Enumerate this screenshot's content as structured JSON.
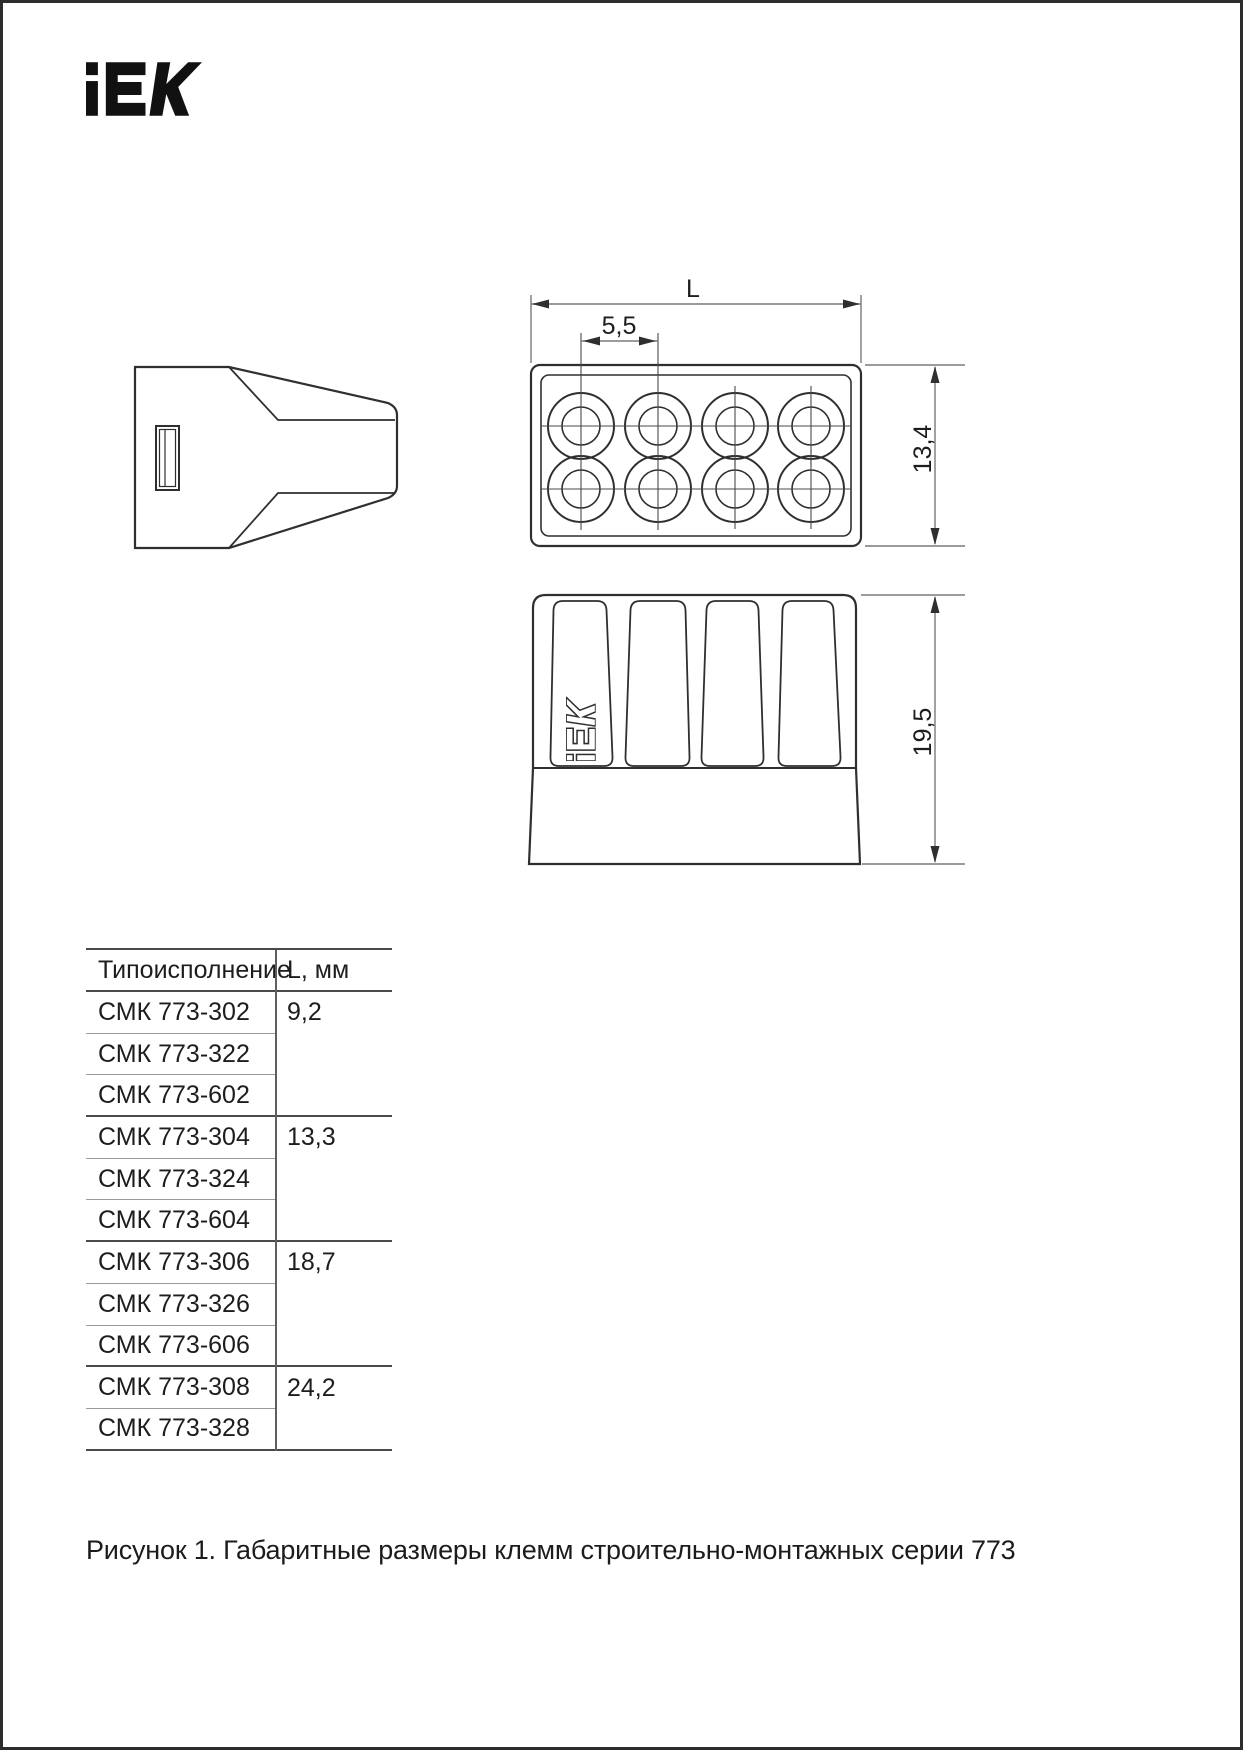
{
  "page": {
    "logo": {
      "name": "iek-logo",
      "text": "IEK"
    },
    "caption": "Рисунок 1. Габаритные размеры клемм строительно-монтажных серии 773"
  },
  "drawing": {
    "labels": {
      "length": "L",
      "pitch": "5,5",
      "body_height": "13,4",
      "total_height": "19,5"
    },
    "embossed_logo": {
      "name": "iek-logo-embossed",
      "text": "IEK"
    },
    "views": [
      "side-view",
      "top-view",
      "front-view"
    ]
  },
  "table": {
    "col_headers": [
      "Типоисполнение",
      "L, мм"
    ],
    "rows": [
      {
        "model": "СМК 773-302",
        "value": "9,2"
      },
      {
        "model": "СМК 773-322",
        "value": ""
      },
      {
        "model": "СМК 773-602",
        "value": ""
      },
      {
        "model": "СМК 773-304",
        "value": "13,3"
      },
      {
        "model": "СМК 773-324",
        "value": ""
      },
      {
        "model": "СМК 773-604",
        "value": ""
      },
      {
        "model": "СМК 773-306",
        "value": "18,7"
      },
      {
        "model": "СМК 773-326",
        "value": ""
      },
      {
        "model": "СМК 773-606",
        "value": ""
      },
      {
        "model": "СМК 773-308",
        "value": "24,2"
      },
      {
        "model": "СМК 773-328",
        "value": ""
      }
    ]
  },
  "colors": {
    "ink": "#1d1d1d",
    "outline": "#2f2f2f",
    "dim_line": "#7a7a7a",
    "table_rule_strong": "#4a4a4a",
    "table_rule_light": "#9a9a9a"
  }
}
